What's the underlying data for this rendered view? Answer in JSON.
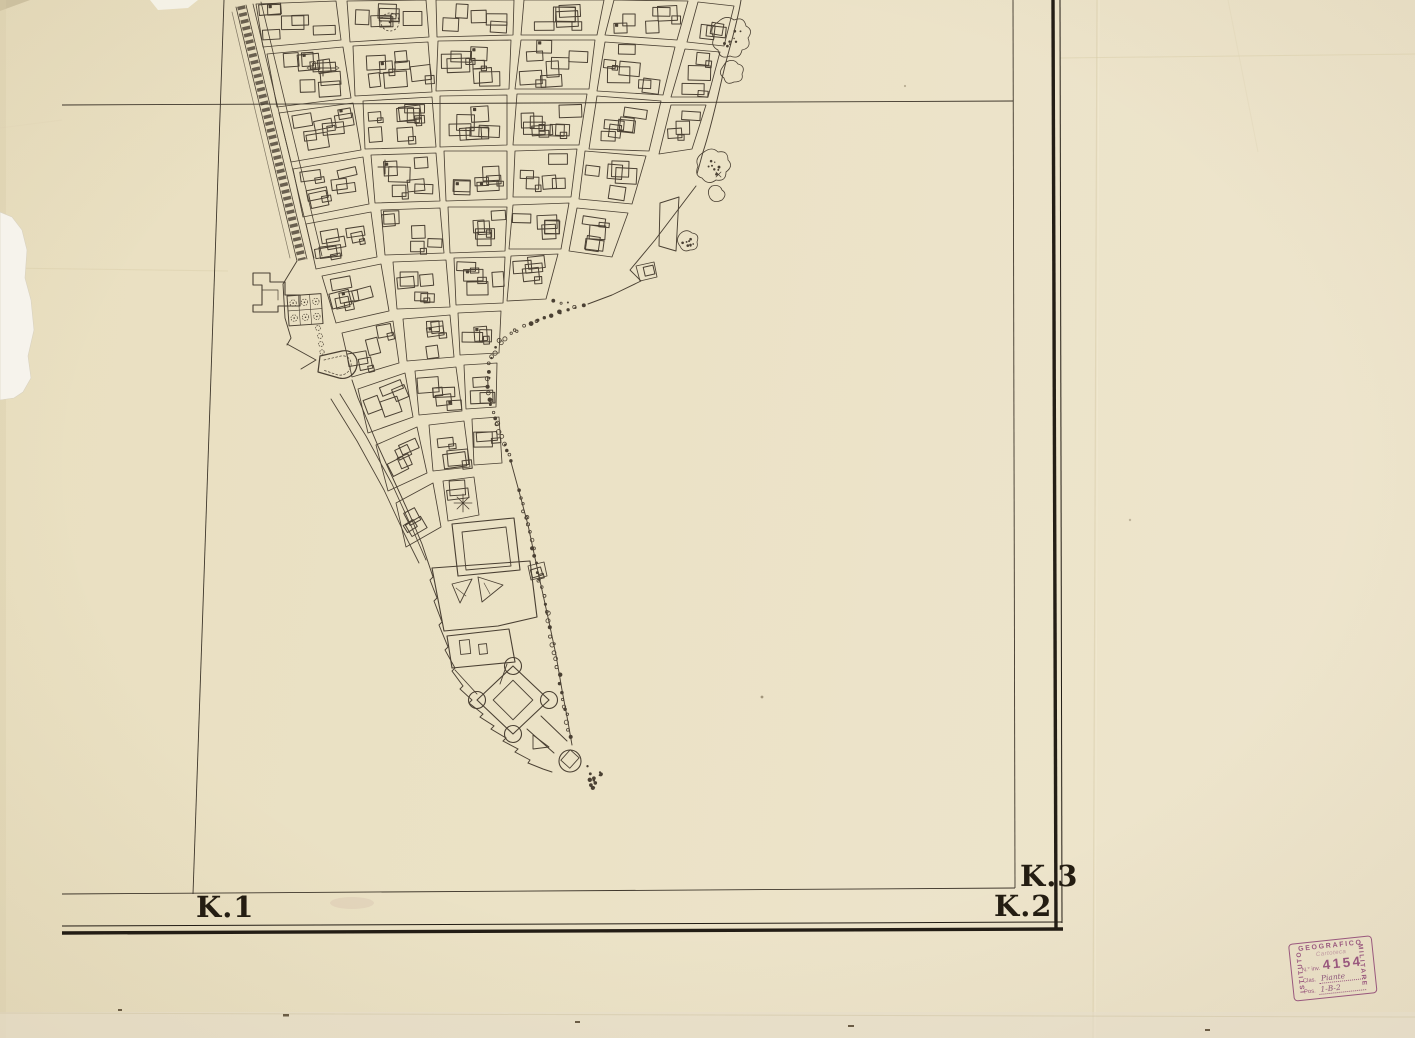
{
  "labels": {
    "k1": "K.1",
    "k2": "K.2",
    "k3": "K.3"
  },
  "stamp": {
    "org_left": "ISTITUTO",
    "org_top": "GEOGRAFICO",
    "org_right": "MILITARE",
    "line1": "Cartoteca",
    "inv_label": "N.° inv.",
    "inv_number": "4154",
    "clas_label": "Clas.",
    "clas_value": "Piante",
    "pos_label": "Pos.",
    "pos_value": "1-B-2"
  },
  "colors": {
    "paper": "#eae0c2",
    "paper_light": "#eee6cf",
    "ink": "#4a4033",
    "ink_dark": "#241d12",
    "stamp_purple": "#9d4f97",
    "tear_white": "#f6f3ec"
  }
}
